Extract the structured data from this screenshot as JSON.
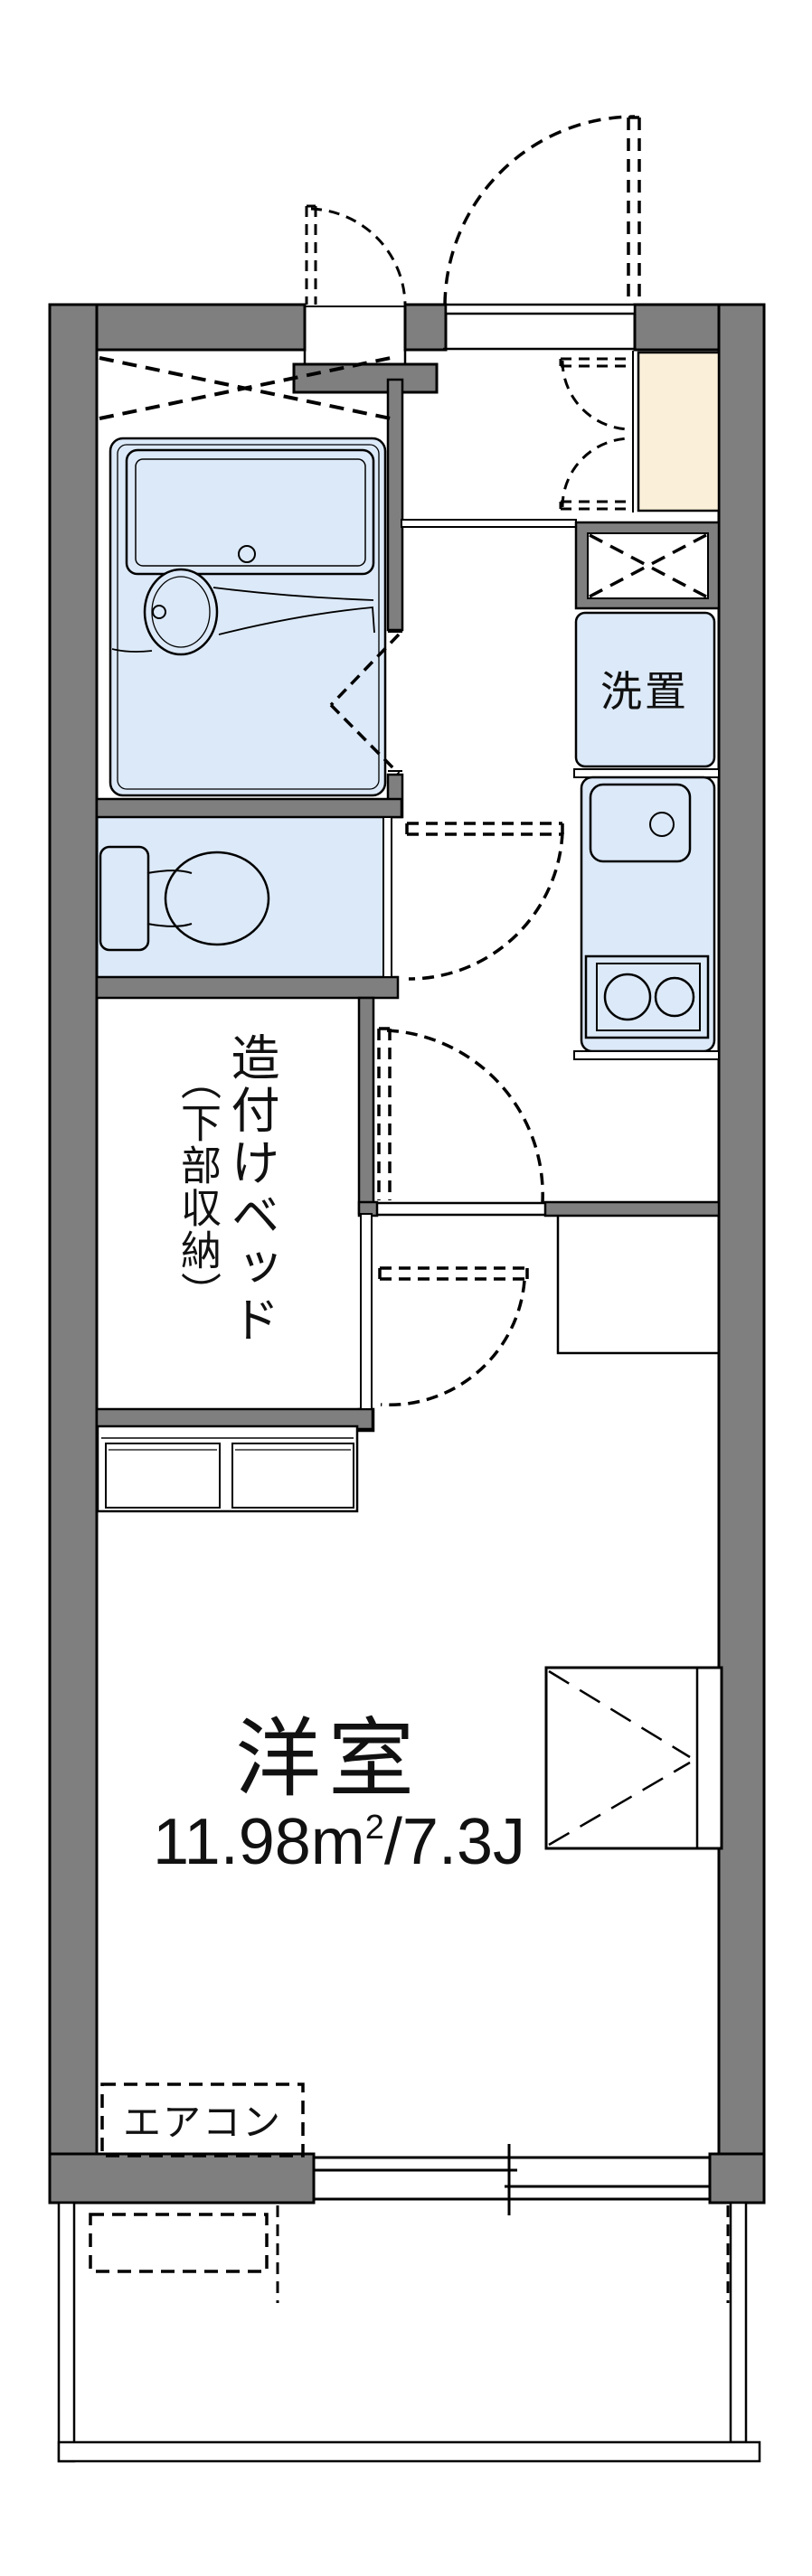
{
  "floor_plan": {
    "type": "japanese-apartment-floorplan",
    "rooms": {
      "western_room": {
        "name": "洋室",
        "area_pre": "11.98m",
        "area_sup": "2",
        "area_post": "/7.3J",
        "area_sqm": 11.98,
        "area_tatami": 7.3
      },
      "built_in_bed": {
        "label_line1": "造付けベッド",
        "label_line2": "（下部収納）"
      },
      "washing_machine_space": {
        "label": "洗置"
      },
      "air_conditioner": {
        "label": "エアコン"
      }
    },
    "fixtures": [
      "bathtub",
      "washbasin",
      "toilet",
      "kitchen-sink",
      "two-burner-stove",
      "shoe-cabinet",
      "under-bed-storage",
      "closet",
      "sliding-window",
      "balcony",
      "outdoor-unit-space"
    ],
    "colors": {
      "wall_gray": "#7f7f7f",
      "water_area_blue": "#dce9f8",
      "shoe_cabinet_beige": "#faf0da",
      "line_black": "#000000",
      "background": "#ffffff"
    }
  }
}
